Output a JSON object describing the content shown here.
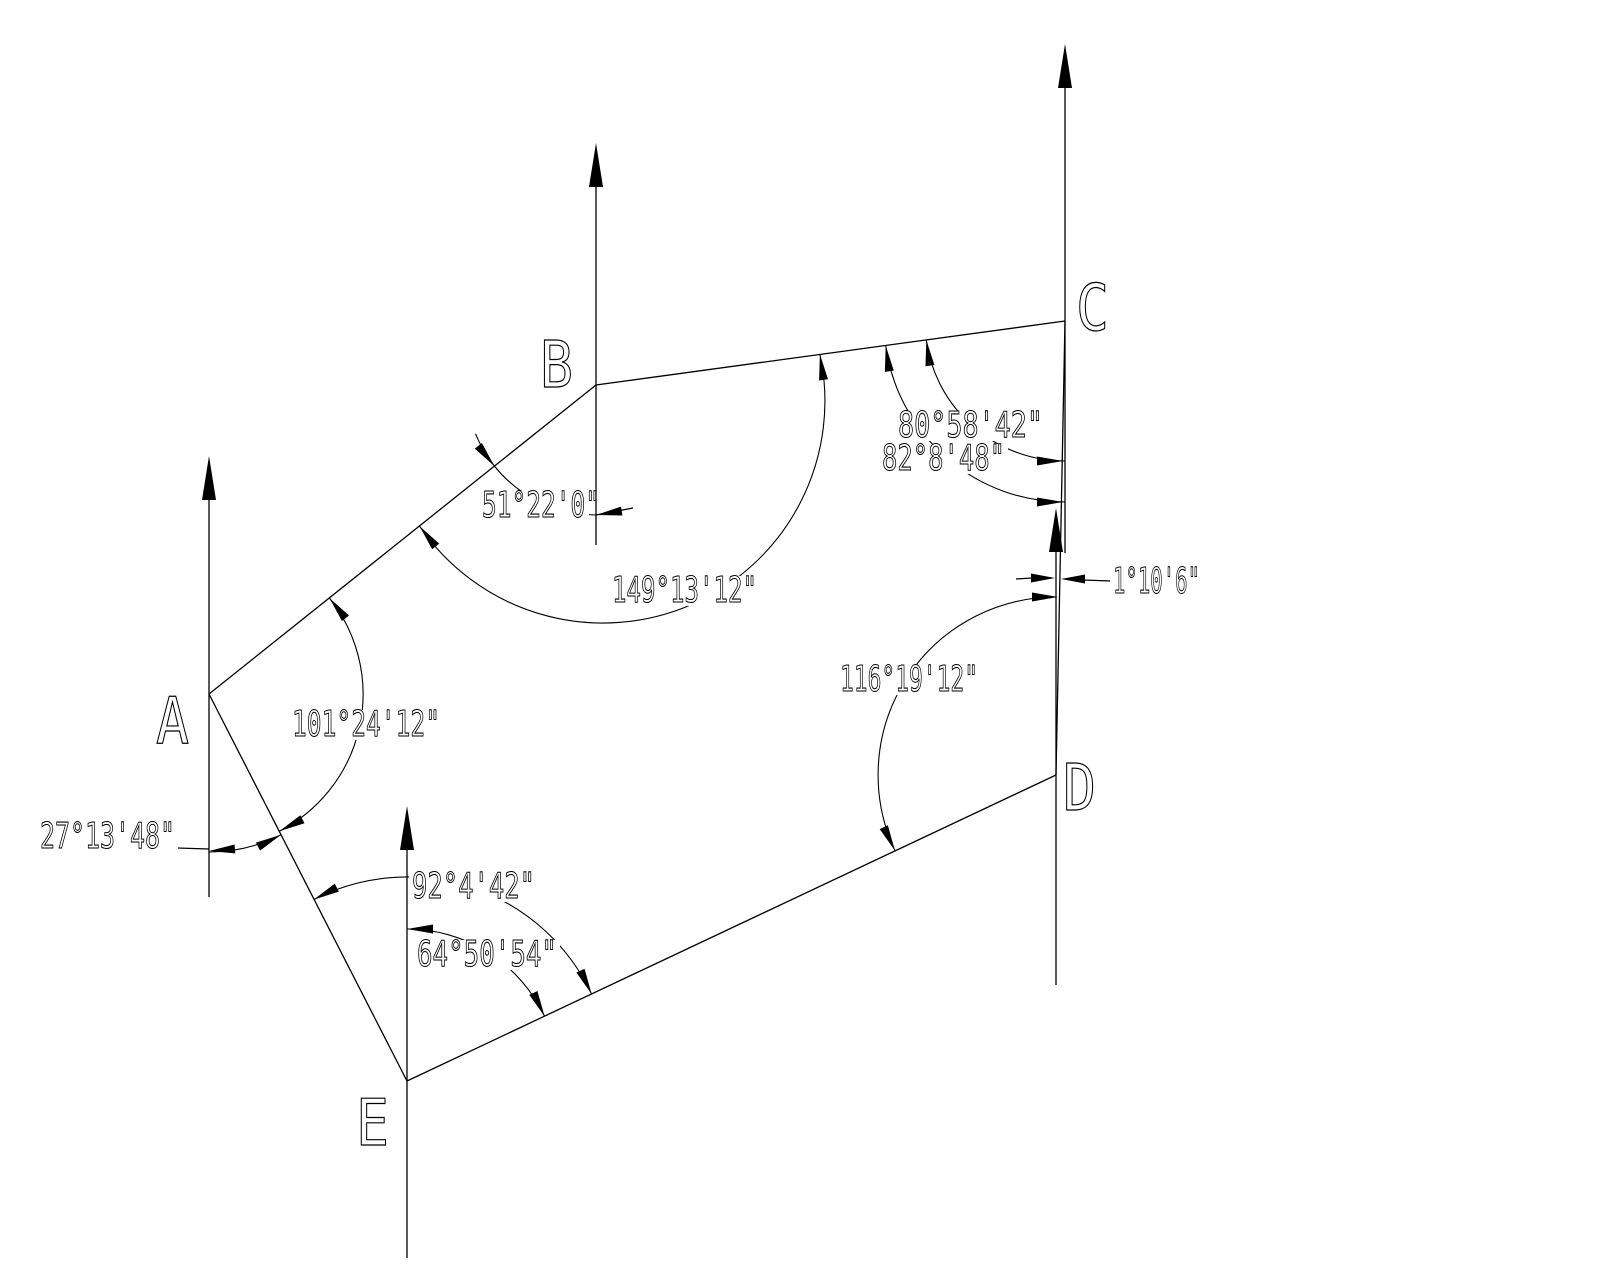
{
  "figure": {
    "description": "CAD survey traverse drawing of pentagon ABCDE with meridian (north) arrows and angular dimensions",
    "background_color": "#ffffff",
    "line_color": "#000000",
    "vertices": [
      {
        "id": "A",
        "x": 209,
        "y": 694
      },
      {
        "id": "B",
        "x": 596,
        "y": 385
      },
      {
        "id": "C",
        "x": 1065,
        "y": 321
      },
      {
        "id": "D",
        "x": 1056,
        "y": 775
      },
      {
        "id": "E",
        "x": 407,
        "y": 1081
      }
    ],
    "angles": [
      {
        "at": "B",
        "kind": "meridian-to-line-BA",
        "value": "51°22'0\""
      },
      {
        "at": "B",
        "kind": "interior",
        "value": "149°13'12\""
      },
      {
        "at": "C",
        "kind": "meridian-to-line-CB-upper",
        "value": "80°58'42\""
      },
      {
        "at": "C",
        "kind": "meridian-to-line-CB-lower",
        "value": "82°8'48\""
      },
      {
        "at": "C-D",
        "kind": "meridian-convergence",
        "value": "1°10'6\""
      },
      {
        "at": "D",
        "kind": "interior",
        "value": "116°19'12\""
      },
      {
        "at": "A",
        "kind": "interior",
        "value": "101°24'12\""
      },
      {
        "at": "A",
        "kind": "meridian-to-line-AE",
        "value": "27°13'48\""
      },
      {
        "at": "E",
        "kind": "interior",
        "value": "92°4'42\""
      },
      {
        "at": "E",
        "kind": "meridian-to-line-ED",
        "value": "64°50'54\""
      }
    ],
    "vertex_labels": [
      {
        "name": "vertex-label-a",
        "text": "A",
        "x": 156,
        "y": 743
      },
      {
        "name": "vertex-label-b",
        "text": "B",
        "x": 540,
        "y": 387
      },
      {
        "name": "vertex-label-c",
        "text": "C",
        "x": 1076,
        "y": 330
      },
      {
        "name": "vertex-label-d",
        "text": "D",
        "x": 1063,
        "y": 810
      },
      {
        "name": "vertex-label-e",
        "text": "E",
        "x": 356,
        "y": 1145
      }
    ],
    "dim_labels": [
      {
        "name": "angle-label-51-22-0",
        "text": "51°22'0\"",
        "x": 482,
        "y": 517,
        "w": 118,
        "mw": 104
      },
      {
        "name": "angle-label-149-13-12",
        "text": "149°13'12\"",
        "x": 612,
        "y": 602,
        "w": 145
      },
      {
        "name": "angle-label-80-58-42",
        "text": "80°58'42\"",
        "x": 898,
        "y": 437,
        "w": 145
      },
      {
        "name": "angle-label-82-8-48",
        "text": "82°8'48\"",
        "x": 882,
        "y": 470,
        "w": 123
      },
      {
        "name": "angle-label-1-10-6",
        "text": "1°10'6\"",
        "x": 1113,
        "y": 593,
        "w": 87
      },
      {
        "name": "angle-label-116-19-12",
        "text": "116°19'12\"",
        "x": 840,
        "y": 691,
        "w": 138
      },
      {
        "name": "angle-label-101-24-12",
        "text": "101°24'12\"",
        "x": 292,
        "y": 736,
        "w": 148
      },
      {
        "name": "angle-label-27-13-48",
        "text": "27°13'48\"",
        "x": 40,
        "y": 848,
        "w": 135
      },
      {
        "name": "angle-label-92-4-42",
        "text": "92°4'42\"",
        "x": 412,
        "y": 898,
        "w": 123
      },
      {
        "name": "angle-label-64-50-54",
        "text": "64°50'54\"",
        "x": 417,
        "y": 966,
        "w": 140
      }
    ],
    "lines": [
      [
        "edge-a-b",
        209,
        694,
        596,
        385
      ],
      [
        "edge-b-c",
        596,
        385,
        1065,
        321
      ],
      [
        "edge-c-d",
        1065,
        321,
        1056,
        775
      ],
      [
        "edge-d-e",
        1056,
        775,
        407,
        1081
      ],
      [
        "edge-e-a",
        407,
        1081,
        209,
        694
      ],
      [
        "meridian-line-a",
        209,
        495,
        209,
        897
      ],
      [
        "meridian-line-b",
        596,
        186,
        596,
        545
      ],
      [
        "meridian-line-c",
        1065,
        84,
        1065,
        553
      ],
      [
        "meridian-line-d",
        1056,
        549,
        1056,
        985
      ],
      [
        "meridian-line-e",
        407,
        847,
        407,
        1258
      ],
      [
        "leader-51-22-0",
        596,
        515,
        633,
        508
      ],
      [
        "leader-27-13-48",
        177,
        848,
        209,
        849
      ],
      [
        "tail-1-10-6",
        1016,
        579,
        1032,
        578
      ],
      [
        "leader-1-10-6",
        1083,
        580,
        1111,
        581
      ]
    ],
    "arcs": [
      [
        "dim-arc-51-22-0",
        "M 596 515 A 130 130 0 0 1 475.5 433.7"
      ],
      [
        "dim-arc-149-13-12",
        "M 819.9 354.1 A 222 222 0 0 1 419.5 526.1"
      ],
      [
        "dim-arc-101-24-12",
        "M 329.3 597.9 A 154 154 0 0 1 279.3 831.2"
      ],
      [
        "dim-arc-27-13-48",
        "M 209 852 A 158 158 0 0 0 281.1 834.7"
      ],
      [
        "dim-arc-92-4-42",
        "M 313.7 899.6 A 204 204 0 0 1 591.7 994.2"
      ],
      [
        "dim-arc-64-50-54",
        "M 407 929 A 152 152 0 0 1 544.6 1016.4"
      ],
      [
        "dim-arc-80-58-42",
        "M 1065 461 A 140 140 0 0 1 926.3 339.9"
      ],
      [
        "dim-arc-82-8-48",
        "M 1065 502 A 181 181 0 0 1 885.7 345.5"
      ],
      [
        "dim-arc-116-19-12",
        "M 1056 597 A 178 178 0 0 0 895 850.7"
      ]
    ],
    "arrowheads": [
      [
        "north-arrow-a",
        209,
        456,
        0,
        -1,
        44,
        7
      ],
      [
        "north-arrow-b",
        596,
        143,
        0,
        -1,
        44,
        7
      ],
      [
        "north-arrow-c",
        1065,
        44,
        0,
        -1,
        44,
        7
      ],
      [
        "north-arrow-d",
        1056,
        508,
        0,
        -1,
        44,
        7
      ],
      [
        "north-arrow-e",
        407,
        806,
        0,
        -1,
        44,
        7
      ],
      [
        "arrow-51-meridian",
        596,
        515,
        -0.98,
        0.15,
        26,
        4.5
      ],
      [
        "arrow-51-line-ab",
        494.5,
        466.2,
        0.62,
        0.78,
        26,
        4.5
      ],
      [
        "arrow-149-line-bc",
        819.9,
        354.1,
        -0.14,
        -0.99,
        26,
        4.5
      ],
      [
        "arrow-149-line-ba",
        419.5,
        526.1,
        -0.62,
        -0.78,
        26,
        4.5
      ],
      [
        "arrow-101-line-ab",
        329.3,
        597.9,
        -0.62,
        -0.78,
        26,
        4.5
      ],
      [
        "arrow-101-line-ae",
        279.3,
        831.2,
        -0.89,
        0.46,
        26,
        4.5
      ],
      [
        "arrow-27-meridian",
        209,
        851,
        -1,
        0.08,
        26,
        4.5
      ],
      [
        "arrow-27-line-ae",
        281.1,
        834.7,
        0.89,
        -0.46,
        26,
        4.5
      ],
      [
        "arrow-92-line-ea",
        313.7,
        899.6,
        -0.89,
        0.46,
        26,
        4.5
      ],
      [
        "arrow-92-line-ed",
        591.7,
        994.2,
        0.43,
        0.9,
        26,
        4.5
      ],
      [
        "arrow-64-meridian",
        407,
        929,
        -1,
        0,
        26,
        4.5
      ],
      [
        "arrow-64-line-ed",
        544.6,
        1016.4,
        0.43,
        0.9,
        26,
        4.5
      ],
      [
        "arrow-80-meridian",
        1063,
        461,
        1,
        0,
        26,
        4.5
      ],
      [
        "arrow-80-line-cb",
        926.3,
        339.9,
        -0.14,
        -0.99,
        26,
        4.5
      ],
      [
        "arrow-82-meridian",
        1063,
        502,
        1,
        0,
        26,
        4.5
      ],
      [
        "arrow-82-line-cb",
        885.7,
        345.5,
        -0.14,
        -0.99,
        26,
        4.5
      ],
      [
        "arrow-116-meridian",
        1058,
        597,
        1,
        0,
        26,
        4.5
      ],
      [
        "arrow-116-line-de",
        895,
        850.7,
        0.43,
        0.9,
        26,
        4.5
      ],
      [
        "arrow-1-10-left",
        1055,
        578,
        1,
        0,
        24,
        4.5
      ],
      [
        "arrow-1-10-right",
        1061,
        579,
        -1,
        0,
        24,
        4.5
      ]
    ],
    "style": {
      "dim_font_size": 36,
      "vertex_font_size": 64,
      "vertex_text_length": 33,
      "line_width": 1.3,
      "arc_width": 1.1
    }
  }
}
